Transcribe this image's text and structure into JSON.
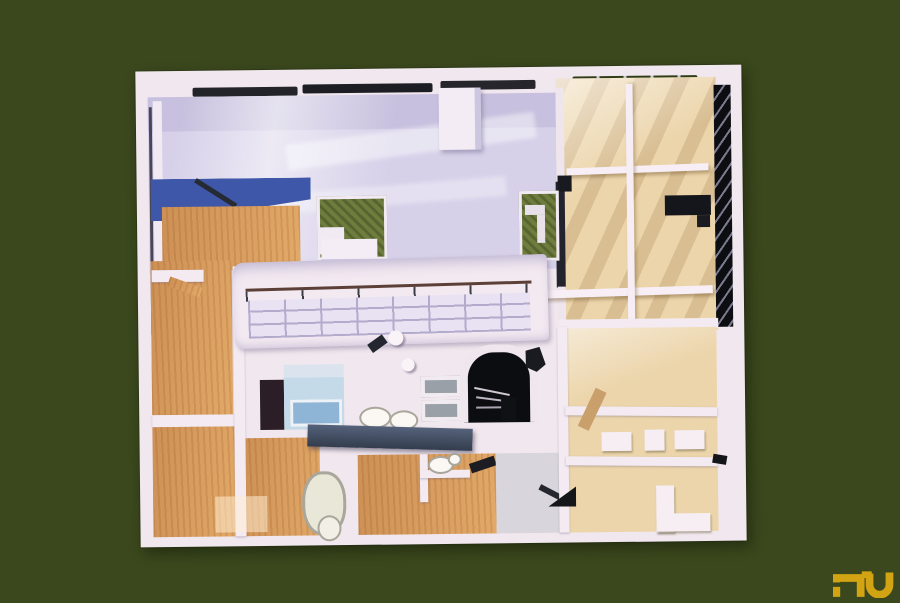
{
  "scene": {
    "type": "photograph",
    "subject": "aerial top view of a white architectural scale model (modernist villa floor plan) on a dark olive background",
    "background_color": "#3b481d"
  },
  "palette": {
    "background_olive": "#3b481d",
    "model_white": "#f1e7ee",
    "shadow_lavender": "#c9c2e0",
    "terrace_lavender": "#d6d0e9",
    "terrace_beige": "#ecd5ab",
    "wood_floor": "#d79a5e",
    "blue_wall": "#3e57a8",
    "garden_green": "#6e7c3e",
    "bath_blue": "#c4dae9",
    "tub_blue": "#8fb5d6",
    "counter_slate": "#47536a",
    "furniture_black": "#15161b",
    "logo_gold": "#d2a413"
  },
  "logo": {
    "text": "nu",
    "color": "#d2a413",
    "position": "bottom-right"
  }
}
